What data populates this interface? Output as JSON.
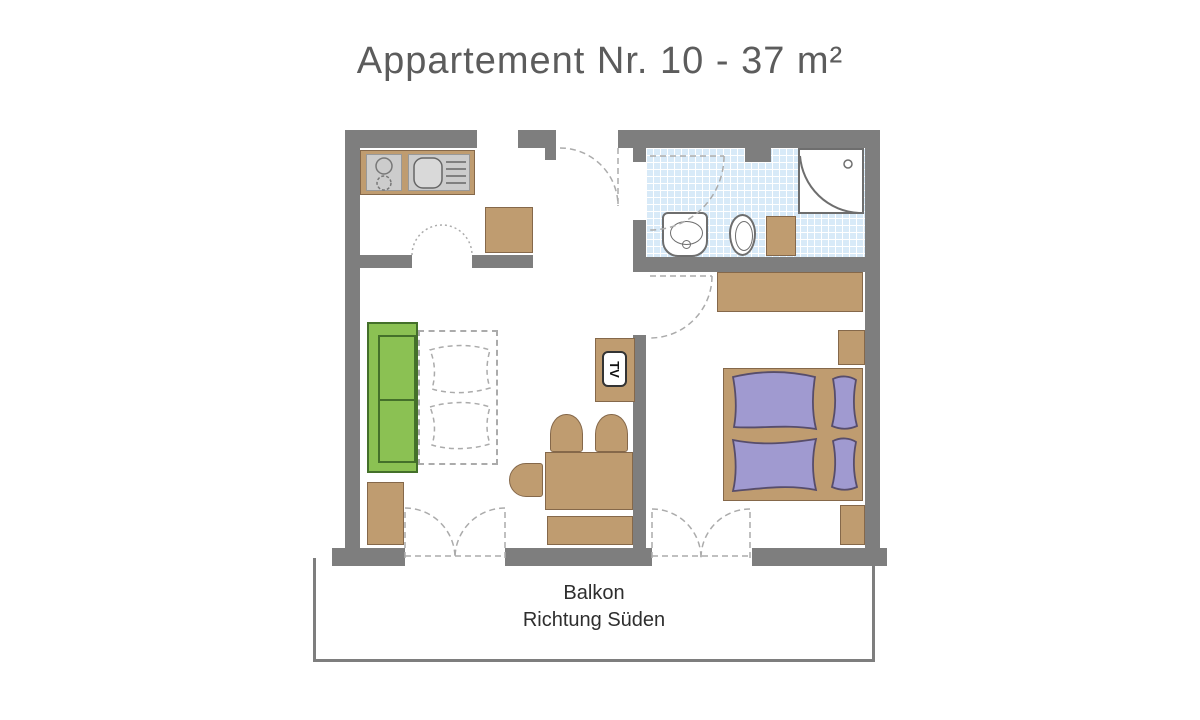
{
  "title": "Appartement Nr. 10 - 37 m²",
  "balcony": {
    "line1": "Balkon",
    "line2": "Richtung Süden"
  },
  "tv_label": "TV",
  "colors": {
    "wall": "#7e7e7e",
    "furniture": "#bf9c70",
    "furniture-border": "#85684a",
    "sofa": "#8bc153",
    "sofa-border": "#44702a",
    "bedding": "#a09ad0",
    "bedding-border": "#574d6b",
    "tile": "#d8eaf8",
    "panel": "#cccccc",
    "fixture": "#6e6e6e",
    "dash": "#ababab",
    "title-text": "#5c5c5c",
    "text": "#2e2e2e"
  }
}
